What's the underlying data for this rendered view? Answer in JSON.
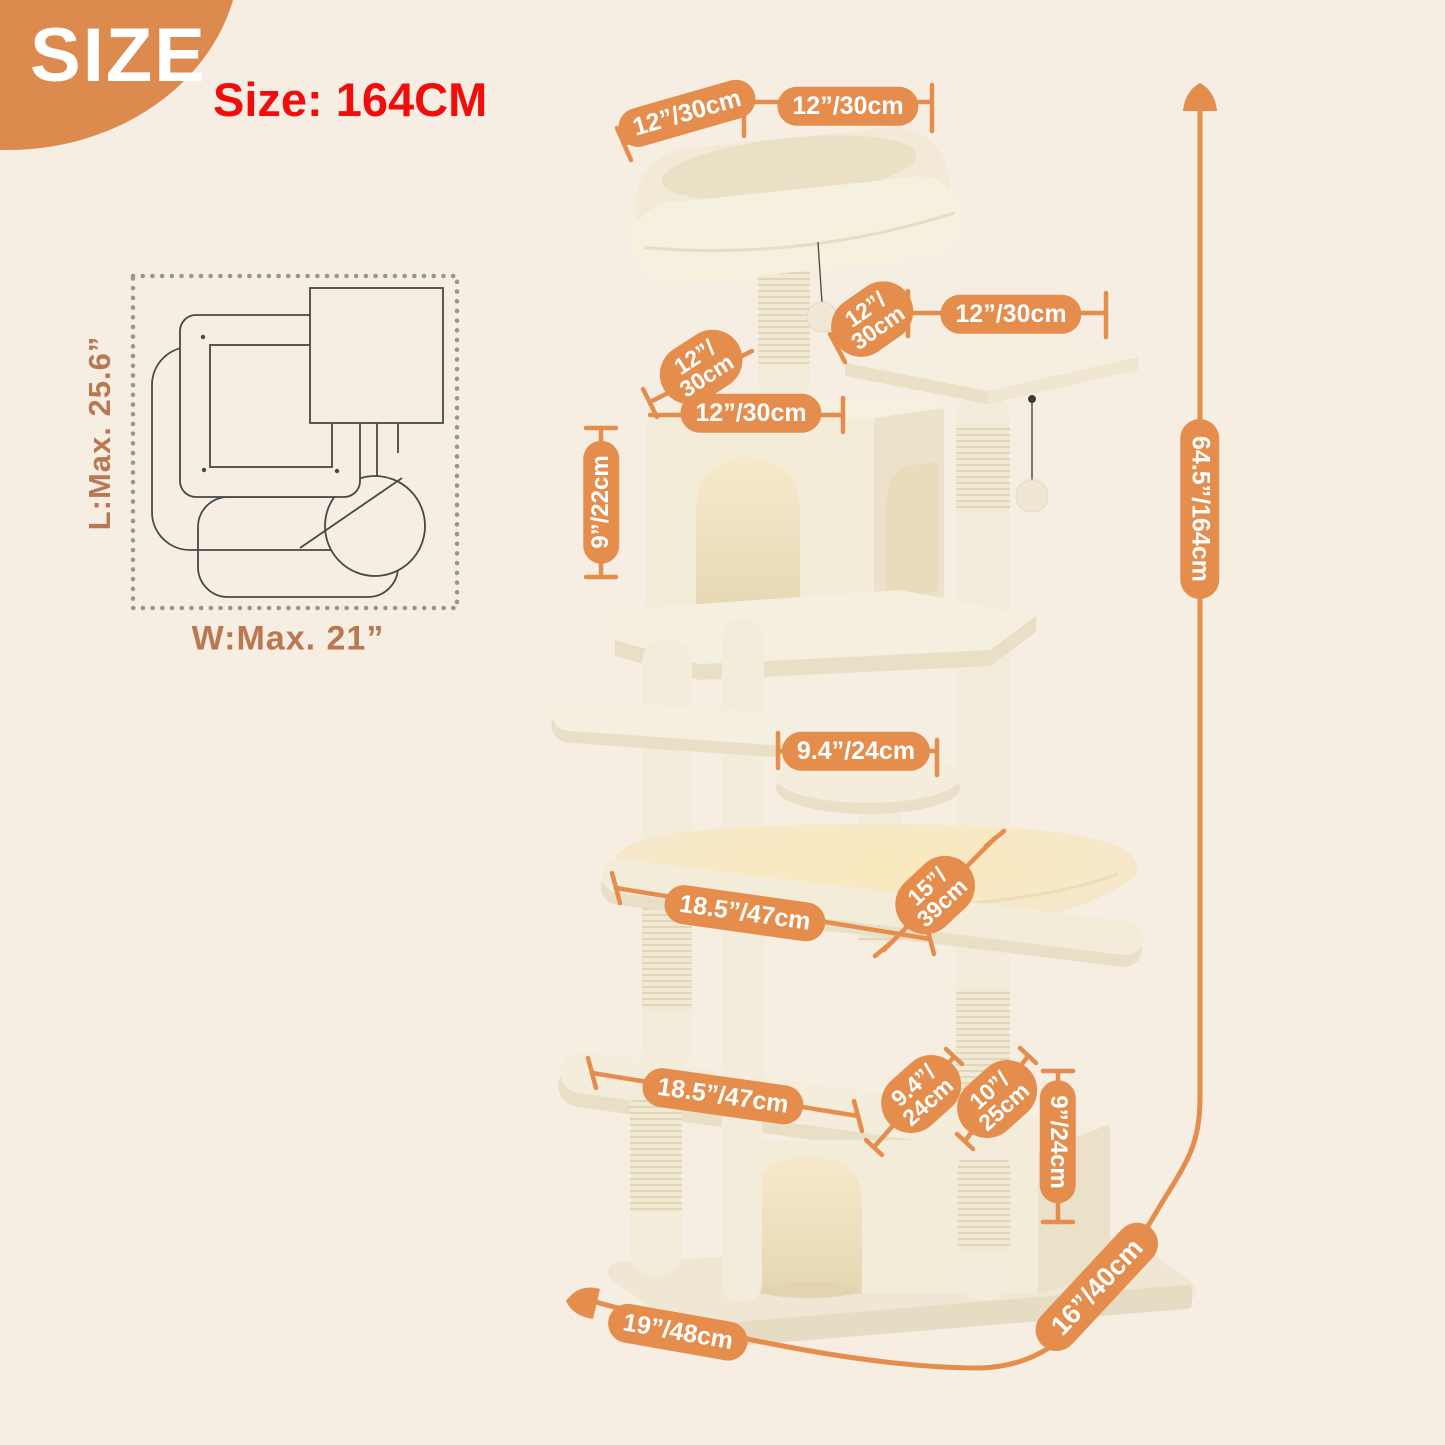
{
  "header": {
    "badge": "SIZE",
    "size_text": "Size: 164CM"
  },
  "top_view": {
    "length": "L:Max. 25.6”",
    "width": "W:Max. 21”"
  },
  "labels": {
    "perch_side": "12”/30cm",
    "perch_front": "12”/30cm",
    "platform_side": "12”/\n30cm",
    "platform_front": "12”/30cm",
    "condo_side": "12”/\n30cm",
    "condo_front": "12”/30cm",
    "condo_height": "9”/22cm",
    "stool_width": "9.4”/24cm",
    "hammock_width": "18.5”/47cm",
    "hammock_depth": "15”/\n39cm",
    "platform_width": "18.5”/47cm",
    "base_depth_small": "9.4”/\n24cm",
    "base_depth_mid": "10”/\n25cm",
    "base_height": "9”/24cm",
    "base_width": "19”/48cm",
    "base_depth": "16”/40cm",
    "total_height": "64.5”/164cm"
  },
  "colors": {
    "background": "#F7EEE3",
    "accent_orange": "#E58D4C",
    "blob_orange": "#DC8A4E",
    "alert_red": "#F20D0D",
    "dimension_text_brown": "#B97851",
    "plush_cream": "#F4EDDB"
  }
}
